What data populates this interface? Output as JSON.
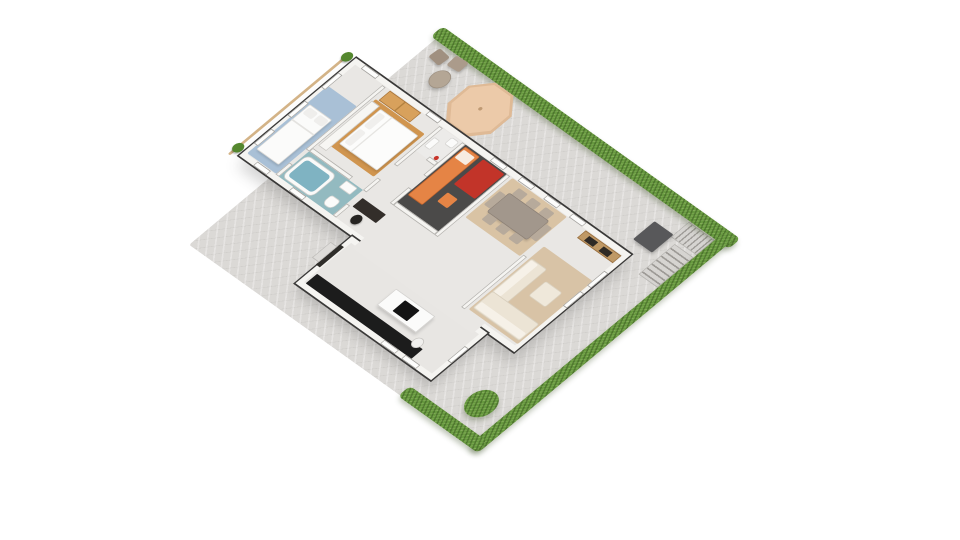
{
  "scene": {
    "type": "isometric-3d-floorplan-render",
    "canvas": {
      "width": 960,
      "height": 540,
      "background": "#ffffff"
    },
    "projection_matrix": [
      0.556,
      0.397,
      -0.672,
      0.561,
      436.3,
      38.3
    ],
    "palette": {
      "paving": "#dbd9d6",
      "hedge_green": "#67993f",
      "bush_green": "#5d9039",
      "wall_white": "#f5f4f1",
      "wall_outline": "#3a3938",
      "floor_light": "#e9e7e4",
      "blue_rug": "#a9c0d6",
      "master_wood_rug": "#d0954f",
      "wood_wardrobe": "#d8a15c",
      "bath_teal": "#93bac0",
      "tub_water": "#7fb3c2",
      "kid_floor_dark": "#4b4a49",
      "kid_bed_orange": "#e58445",
      "kid_rug_red": "#c23429",
      "dining_rug_tan": "#d9c3a4",
      "sofa_cream": "#ece4d5",
      "tv_console_wood": "#bf9966",
      "kitchen_counter_black": "#1c1c1c",
      "octagon_tan": "#eccaa9",
      "stair_gray": "#9e9b97",
      "mat_gray": "#58585a"
    },
    "items": [
      {
        "n": "yard-paving",
        "x": 0,
        "y": 0,
        "w": 520,
        "h": 368,
        "cls": "paving",
        "r": 3
      },
      {
        "n": "corner-stairs-upper",
        "x": 458,
        "y": 3,
        "w": 46,
        "h": 27,
        "cls": "stx"
      },
      {
        "n": "corner-stairs-lower",
        "x": 470,
        "y": 34,
        "w": 34,
        "h": 54,
        "cls": "sty"
      },
      {
        "n": "yard-mat",
        "x": 424,
        "y": 26,
        "w": 34,
        "h": 32,
        "f": "#58585a",
        "r": 2,
        "sh": "2px 2px 4px rgba(0,0,0,.25)"
      },
      {
        "n": "hedge-northeast",
        "x": -8,
        "y": -16,
        "w": 536,
        "h": 18,
        "cls": "hedge"
      },
      {
        "n": "hedge-southeast",
        "x": 504,
        "y": -14,
        "w": 18,
        "h": 384,
        "cls": "hedge"
      },
      {
        "n": "hedge-southwest",
        "x": 378,
        "y": 352,
        "w": 140,
        "h": 18,
        "cls": "hedge"
      },
      {
        "n": "garden-bush",
        "t": "circle",
        "x": 448,
        "y": 300,
        "w": 40,
        "h": 40,
        "cls": "hedge",
        "r": "50%"
      },
      {
        "n": "patio-octagon-base",
        "t": "oct",
        "x": 86,
        "y": 2,
        "w": 78,
        "h": 74,
        "f": "#dfba96",
        "sh": "3px 4px 6px rgba(0,0,0,.18)"
      },
      {
        "n": "patio-octagon-top",
        "t": "oct",
        "x": 90,
        "y": 5,
        "w": 70,
        "h": 66,
        "f": "#eccaa9"
      },
      {
        "n": "patio-octagon-dot",
        "t": "circle",
        "x": 122,
        "y": 35,
        "w": 5,
        "h": 5,
        "f": "#bf9a74"
      },
      {
        "n": "patio-round-table",
        "t": "circle",
        "x": 38,
        "y": 24,
        "w": 26,
        "h": 26,
        "f": "#b4a695",
        "b": "1px solid #9c8f80",
        "sh": "2px 3px 4px rgba(0,0,0,.2)"
      },
      {
        "n": "patio-chair-a",
        "x": 14,
        "y": 8,
        "w": 21,
        "h": 16,
        "f": "#a09080",
        "r": 3,
        "rot": 6,
        "sh": "2px 2px 3px rgba(0,0,0,.2)"
      },
      {
        "n": "patio-chair-b",
        "x": 40,
        "y": 2,
        "w": 21,
        "h": 16,
        "f": "#ab9b8b",
        "r": 3,
        "rot": -4,
        "sh": "2px 2px 3px rgba(0,0,0,.2)"
      },
      {
        "n": "balcony-railing",
        "x": -68,
        "y": 76,
        "w": 4,
        "h": 178,
        "f": "#d4b488",
        "r": 2
      },
      {
        "n": "balcony-plant-north",
        "t": "circle",
        "x": -72,
        "y": 72,
        "w": 14,
        "h": 14,
        "f": "#55882f",
        "sh": "1px 2px 2px rgba(0,0,0,.25)"
      },
      {
        "n": "balcony-plant-south",
        "t": "circle",
        "x": -72,
        "y": 234,
        "w": 14,
        "h": 14,
        "f": "#55882f",
        "sh": "1px 2px 2px rgba(0,0,0,.25)"
      },
      {
        "n": "house-main-block",
        "x": -55,
        "y": 74,
        "w": 495,
        "h": 174,
        "f": "#e9e7e4",
        "b": "7px solid #f5f4f1",
        "o": "2px solid #3a3938",
        "sh": "10px 12px 18px rgba(70,70,70,.22)"
      },
      {
        "n": "house-kitchen-block",
        "x": 148,
        "y": 248,
        "w": 244,
        "h": 84,
        "f": "#e8e6e3",
        "b": "7px solid #f5f4f1",
        "o": "2px solid #3a3938",
        "sh": "8px 10px 14px rgba(70,70,70,.20)"
      },
      {
        "n": "openplan-seam",
        "x": 162,
        "y": 239,
        "w": 216,
        "h": 20,
        "f": "#e9e7e4"
      },
      {
        "n": "bedroom1-rug",
        "x": -50,
        "y": 120,
        "w": 52,
        "h": 120,
        "f": "#a9c0d6",
        "r": 2
      },
      {
        "n": "bedroom1-bed",
        "x": -46,
        "y": 150,
        "w": 40,
        "h": 80,
        "f": "#fbfbfa",
        "b": "1px solid #d9d8d5",
        "r": 2,
        "sh": "2px 2px 3px rgba(0,0,0,.12)"
      },
      {
        "n": "bedroom1-pillow-a",
        "x": -43,
        "y": 153,
        "w": 16,
        "h": 11,
        "f": "#efeeec",
        "r": 3
      },
      {
        "n": "bedroom1-pillow-b",
        "x": -24,
        "y": 153,
        "w": 16,
        "h": 11,
        "f": "#efeeec",
        "r": 3
      },
      {
        "n": "bedroom1-duvet-fold",
        "x": -46,
        "y": 176,
        "w": 40,
        "h": 2,
        "f": "#e4e3e0"
      },
      {
        "n": "master-wood-rug",
        "x": 12,
        "y": 100,
        "w": 88,
        "h": 76,
        "f": "#d0954f",
        "r": 2
      },
      {
        "n": "master-dresser",
        "x": 10,
        "y": 104,
        "w": 14,
        "h": 80,
        "f": "#f7f6f3",
        "b": "1px solid #c9c7c3"
      },
      {
        "n": "master-bed",
        "x": 28,
        "y": 106,
        "w": 68,
        "h": 62,
        "f": "#fcfcfb",
        "b": "1px solid #dad9d6",
        "r": 2,
        "sh": "2px 2px 3px rgba(0,0,0,.12)"
      },
      {
        "n": "master-pillow-a",
        "x": 31,
        "y": 110,
        "w": 11,
        "h": 24,
        "f": "#f0efed",
        "r": 3
      },
      {
        "n": "master-pillow-b",
        "x": 31,
        "y": 139,
        "w": 11,
        "h": 24,
        "f": "#f0efed",
        "r": 3
      },
      {
        "n": "master-duvet-fold",
        "x": 48,
        "y": 106,
        "w": 2,
        "h": 62,
        "f": "#e6e5e2"
      },
      {
        "n": "master-wood-wardrobe",
        "x": 16,
        "y": 82,
        "w": 56,
        "h": 17,
        "f": "#d8a15c",
        "b": "1px solid #a9763d"
      },
      {
        "n": "master-wardrobe-door-line",
        "x": 43,
        "y": 83,
        "w": 2,
        "h": 15,
        "f": "#b3813f"
      },
      {
        "n": "bathroom-floor",
        "x": 8,
        "y": 196,
        "w": 97,
        "h": 45,
        "f": "#93bac0",
        "cls": "mosaic"
      },
      {
        "n": "bathroom-tub",
        "x": 10,
        "y": 200,
        "w": 54,
        "h": 39,
        "f": "#fafaf9",
        "b": "1px solid #cfcecb",
        "r": 8
      },
      {
        "n": "bathroom-tub-water",
        "x": 15,
        "y": 205,
        "w": 44,
        "h": 29,
        "f": "#7fb3c2",
        "cls": "mosaic",
        "r": 5
      },
      {
        "n": "bathroom-sink",
        "x": 78,
        "y": 198,
        "w": 20,
        "h": 12,
        "f": "#fbfbfa",
        "b": "1px solid #d5d4d1",
        "r": 2
      },
      {
        "n": "bathroom-toilet",
        "x": 80,
        "y": 222,
        "w": 17,
        "h": 15,
        "f": "#fbfbfa",
        "b": "1px solid #d5d4d1",
        "r": "4px 4px 7px 7px"
      },
      {
        "n": "wall-bedroom1-a",
        "x": 2,
        "y": 82,
        "w": 6,
        "h": 114,
        "f": "#f5f4f1",
        "b": "1px solid #b3b1ad"
      },
      {
        "n": "wall-bedroom1-b",
        "x": 2,
        "y": 220,
        "w": 6,
        "h": 21,
        "f": "#f5f4f1",
        "b": "1px solid #b3b1ad"
      },
      {
        "n": "wall-master-bath-a",
        "x": 8,
        "y": 190,
        "w": 72,
        "h": 6,
        "f": "#f5f4f1",
        "b": "1px solid #b3b1ad"
      },
      {
        "n": "wall-column-a",
        "x": 105,
        "y": 82,
        "w": 6,
        "h": 68,
        "f": "#f5f4f1",
        "b": "1px solid #b3b1ad"
      },
      {
        "n": "wall-column-b",
        "x": 105,
        "y": 174,
        "w": 6,
        "h": 22,
        "f": "#f5f4f1",
        "b": "1px solid #b3b1ad"
      },
      {
        "n": "wall-column-c",
        "x": 105,
        "y": 220,
        "w": 6,
        "h": 21,
        "f": "#f5f4f1",
        "b": "1px solid #b3b1ad"
      },
      {
        "n": "wc-floor",
        "x": 111,
        "y": 82,
        "w": 35,
        "h": 40,
        "f": "#ecebe9"
      },
      {
        "n": "wc-sink",
        "x": 113,
        "y": 96,
        "w": 10,
        "h": 16,
        "f": "#fbfbfa",
        "b": "1px solid #d5d4d1",
        "r": 2
      },
      {
        "n": "wc-toilet",
        "x": 130,
        "y": 84,
        "w": 13,
        "h": 12,
        "f": "#fbfbfa",
        "b": "1px solid #d5d4d1",
        "r": 3
      },
      {
        "n": "wc-red-accent",
        "t": "circle",
        "x": 136,
        "y": 112,
        "w": 6,
        "h": 6,
        "f": "#c8352b"
      },
      {
        "n": "wall-wc-south",
        "x": 131,
        "y": 118,
        "w": 15,
        "h": 6,
        "f": "#f5f4f1",
        "b": "1px solid #b3b1ad"
      },
      {
        "n": "wall-wc-kid-a",
        "x": 146,
        "y": 82,
        "w": 6,
        "h": 58,
        "f": "#f5f4f1",
        "b": "1px solid #b3b1ad"
      },
      {
        "n": "wall-wc-kid-b",
        "x": 146,
        "y": 162,
        "w": 6,
        "h": 28,
        "f": "#f5f4f1",
        "b": "1px solid #b3b1ad"
      },
      {
        "n": "kidroom-floor",
        "x": 152,
        "y": 82,
        "w": 74,
        "h": 102,
        "f": "#4b4a49"
      },
      {
        "n": "kidroom-bed",
        "x": 154,
        "y": 84,
        "w": 26,
        "h": 86,
        "f": "#e58445",
        "b": "1px solid #c4642c",
        "r": 2
      },
      {
        "n": "kidroom-pillow",
        "x": 156,
        "y": 88,
        "w": 20,
        "h": 14,
        "f": "#f7ece1",
        "r": 2
      },
      {
        "n": "kidroom-red-rug",
        "x": 186,
        "y": 84,
        "w": 38,
        "h": 44,
        "f": "#c23429",
        "r": 2
      },
      {
        "n": "kidroom-side-table",
        "x": 190,
        "y": 140,
        "w": 18,
        "h": 16,
        "f": "#e58445",
        "r": 2
      },
      {
        "n": "wall-kid-east",
        "x": 226,
        "y": 82,
        "w": 6,
        "h": 108,
        "f": "#f5f4f1",
        "b": "1px solid #b3b1ad"
      },
      {
        "n": "wall-kid-south",
        "x": 152,
        "y": 184,
        "w": 74,
        "h": 6,
        "f": "#f5f4f1",
        "b": "1px solid #b3b1ad"
      },
      {
        "n": "office-desk",
        "x": 114,
        "y": 204,
        "w": 42,
        "h": 15,
        "f": "#332e2a",
        "r": 1
      },
      {
        "n": "office-chair",
        "t": "circle",
        "x": 126,
        "y": 222,
        "w": 14,
        "h": 14,
        "f": "#262421",
        "sh": "1px 1px 2px rgba(0,0,0,.3)"
      },
      {
        "n": "dining-rug",
        "x": 236,
        "y": 82,
        "w": 98,
        "h": 70,
        "f": "#d9c3a4",
        "r": 2
      },
      {
        "n": "dining-table",
        "x": 250,
        "y": 98,
        "w": 72,
        "h": 34,
        "f": "#a2978c",
        "b": "1px solid #8d8278",
        "r": 3,
        "sh": "2px 2px 3px rgba(0,0,0,.15)"
      },
      {
        "n": "dining-chair-n1",
        "x": 254,
        "y": 87,
        "w": 16,
        "h": 11,
        "f": "#b7aa9b",
        "r": 2
      },
      {
        "n": "dining-chair-n2",
        "x": 278,
        "y": 87,
        "w": 16,
        "h": 11,
        "f": "#b7aa9b",
        "r": 2
      },
      {
        "n": "dining-chair-n3",
        "x": 302,
        "y": 87,
        "w": 16,
        "h": 11,
        "f": "#b7aa9b",
        "r": 2
      },
      {
        "n": "dining-chair-s1",
        "x": 254,
        "y": 132,
        "w": 16,
        "h": 11,
        "f": "#b7aa9b",
        "r": 2
      },
      {
        "n": "dining-chair-s2",
        "x": 278,
        "y": 132,
        "w": 16,
        "h": 11,
        "f": "#b7aa9b",
        "r": 2
      },
      {
        "n": "dining-chair-s3",
        "x": 302,
        "y": 132,
        "w": 16,
        "h": 11,
        "f": "#b7aa9b",
        "r": 2
      },
      {
        "n": "dining-chair-w",
        "x": 239,
        "y": 103,
        "w": 11,
        "h": 24,
        "f": "#b7aa9b",
        "r": 2
      },
      {
        "n": "dining-chair-e",
        "x": 322,
        "y": 103,
        "w": 11,
        "h": 24,
        "f": "#b7aa9b",
        "r": 2
      },
      {
        "n": "living-rug",
        "x": 346,
        "y": 126,
        "w": 88,
        "h": 112,
        "f": "#d8c3a6",
        "r": 2
      },
      {
        "n": "wall-sofa-half",
        "x": 336,
        "y": 148,
        "w": 6,
        "h": 93,
        "f": "#f5f4f1",
        "b": "1px solid #b3b1ad"
      },
      {
        "n": "sofa-west-run",
        "x": 348,
        "y": 146,
        "w": 28,
        "h": 60,
        "f": "#ece4d5",
        "b": "1px solid #d8cfbe",
        "r": 3
      },
      {
        "n": "sofa-west-cushions",
        "x": 350,
        "y": 148,
        "w": 12,
        "h": 56,
        "f": "#f6f1e8",
        "r": 2
      },
      {
        "n": "sofa-south-run",
        "x": 348,
        "y": 204,
        "w": 84,
        "h": 30,
        "f": "#ece4d5",
        "b": "1px solid #d8cfbe",
        "r": 3
      },
      {
        "n": "sofa-south-cushions",
        "x": 350,
        "y": 222,
        "w": 80,
        "h": 10,
        "f": "#f6f1e8",
        "r": 2
      },
      {
        "n": "sofa-ottoman",
        "x": 388,
        "y": 158,
        "w": 30,
        "h": 26,
        "f": "#efe8da",
        "b": "1px solid #dbd2c1",
        "r": 3
      },
      {
        "n": "tv-console",
        "x": 368,
        "y": 82,
        "w": 64,
        "h": 13,
        "f": "#bf9966",
        "b": "1px solid #996f3f"
      },
      {
        "n": "tv-console-insert-a",
        "x": 378,
        "y": 85,
        "w": 16,
        "h": 8,
        "f": "#2e2a25"
      },
      {
        "n": "tv-console-insert-b",
        "x": 404,
        "y": 85,
        "w": 16,
        "h": 8,
        "f": "#2e2a25"
      },
      {
        "n": "kitchen-counter",
        "x": 158,
        "y": 308,
        "w": 190,
        "h": 17,
        "f": "#1c1c1c",
        "r": 1
      },
      {
        "n": "kitchen-island",
        "x": 252,
        "y": 268,
        "w": 70,
        "h": 29,
        "f": "#fbfbfa",
        "b": "1px solid #d2d0cd",
        "sh": "2px 3px 4px rgba(0,0,0,.15)"
      },
      {
        "n": "kitchen-cooktop",
        "x": 274,
        "y": 273,
        "w": 26,
        "h": 19,
        "f": "#141414",
        "r": 1
      },
      {
        "n": "kitchen-stool",
        "t": "circle",
        "x": 328,
        "y": 298,
        "w": 15,
        "h": 15,
        "f": "#f1f0ee",
        "b": "1px solid #c7c5c2"
      },
      {
        "n": "entry-door",
        "x": 146,
        "y": 264,
        "w": 7,
        "h": 36,
        "f": "#2f2d2a"
      },
      {
        "n": "entry-step",
        "x": 134,
        "y": 268,
        "w": 12,
        "h": 28,
        "f": "#dedcd9",
        "b": "1px solid #bdbbb8"
      },
      {
        "n": "window-front-bedroom1",
        "x": -38,
        "y": 74,
        "w": 26,
        "h": 7,
        "f": "#fdfdfc",
        "b": "1px solid #a3a19d"
      },
      {
        "n": "window-front-master",
        "x": 78,
        "y": 74,
        "w": 22,
        "h": 7,
        "f": "#fdfdfc",
        "b": "1px solid #a3a19d"
      },
      {
        "n": "window-front-kid",
        "x": 194,
        "y": 74,
        "w": 24,
        "h": 7,
        "f": "#fdfdfc",
        "b": "1px solid #a3a19d"
      },
      {
        "n": "window-front-dining-a",
        "x": 244,
        "y": 74,
        "w": 24,
        "h": 7,
        "f": "#fdfdfc",
        "b": "1px solid #a3a19d"
      },
      {
        "n": "window-front-dining-b",
        "x": 290,
        "y": 74,
        "w": 24,
        "h": 7,
        "f": "#fdfdfc",
        "b": "1px solid #a3a19d"
      },
      {
        "n": "window-front-living",
        "x": 336,
        "y": 74,
        "w": 24,
        "h": 7,
        "f": "#fdfdfc",
        "b": "1px solid #a3a19d"
      },
      {
        "n": "window-nw-a",
        "x": -55,
        "y": 100,
        "w": 7,
        "h": 26,
        "f": "#fdfdfc",
        "b": "1px solid #a3a19d"
      },
      {
        "n": "window-nw-b",
        "x": -55,
        "y": 150,
        "w": 7,
        "h": 26,
        "f": "#fdfdfc",
        "b": "1px solid #a3a19d"
      },
      {
        "n": "window-nw-c",
        "x": -55,
        "y": 200,
        "w": 7,
        "h": 26,
        "f": "#fdfdfc",
        "b": "1px solid #a3a19d"
      },
      {
        "n": "window-se-living-a",
        "x": 433,
        "y": 108,
        "w": 7,
        "h": 26,
        "f": "#fdfdfc",
        "b": "1px solid #a3a19d"
      },
      {
        "n": "window-se-living-b",
        "x": 433,
        "y": 144,
        "w": 7,
        "h": 26,
        "f": "#fdfdfc",
        "b": "1px solid #a3a19d"
      },
      {
        "n": "window-sw-main-a",
        "x": -30,
        "y": 241,
        "w": 24,
        "h": 7,
        "f": "#fdfdfc",
        "b": "1px solid #a3a19d"
      },
      {
        "n": "window-sw-main-b",
        "x": 34,
        "y": 241,
        "w": 24,
        "h": 7,
        "f": "#fdfdfc",
        "b": "1px solid #a3a19d"
      },
      {
        "n": "window-kitchen-se",
        "x": 385,
        "y": 276,
        "w": 7,
        "h": 26,
        "f": "#fdfdfc",
        "b": "1px solid #a3a19d"
      },
      {
        "n": "window-kitchen-sw-a",
        "x": 300,
        "y": 325,
        "w": 26,
        "h": 7,
        "f": "#fdfdfc",
        "b": "1px solid #a3a19d"
      },
      {
        "n": "window-kitchen-sw-b",
        "x": 338,
        "y": 325,
        "w": 26,
        "h": 7,
        "f": "#fdfdfc",
        "b": "1px solid #a3a19d"
      }
    ]
  }
}
